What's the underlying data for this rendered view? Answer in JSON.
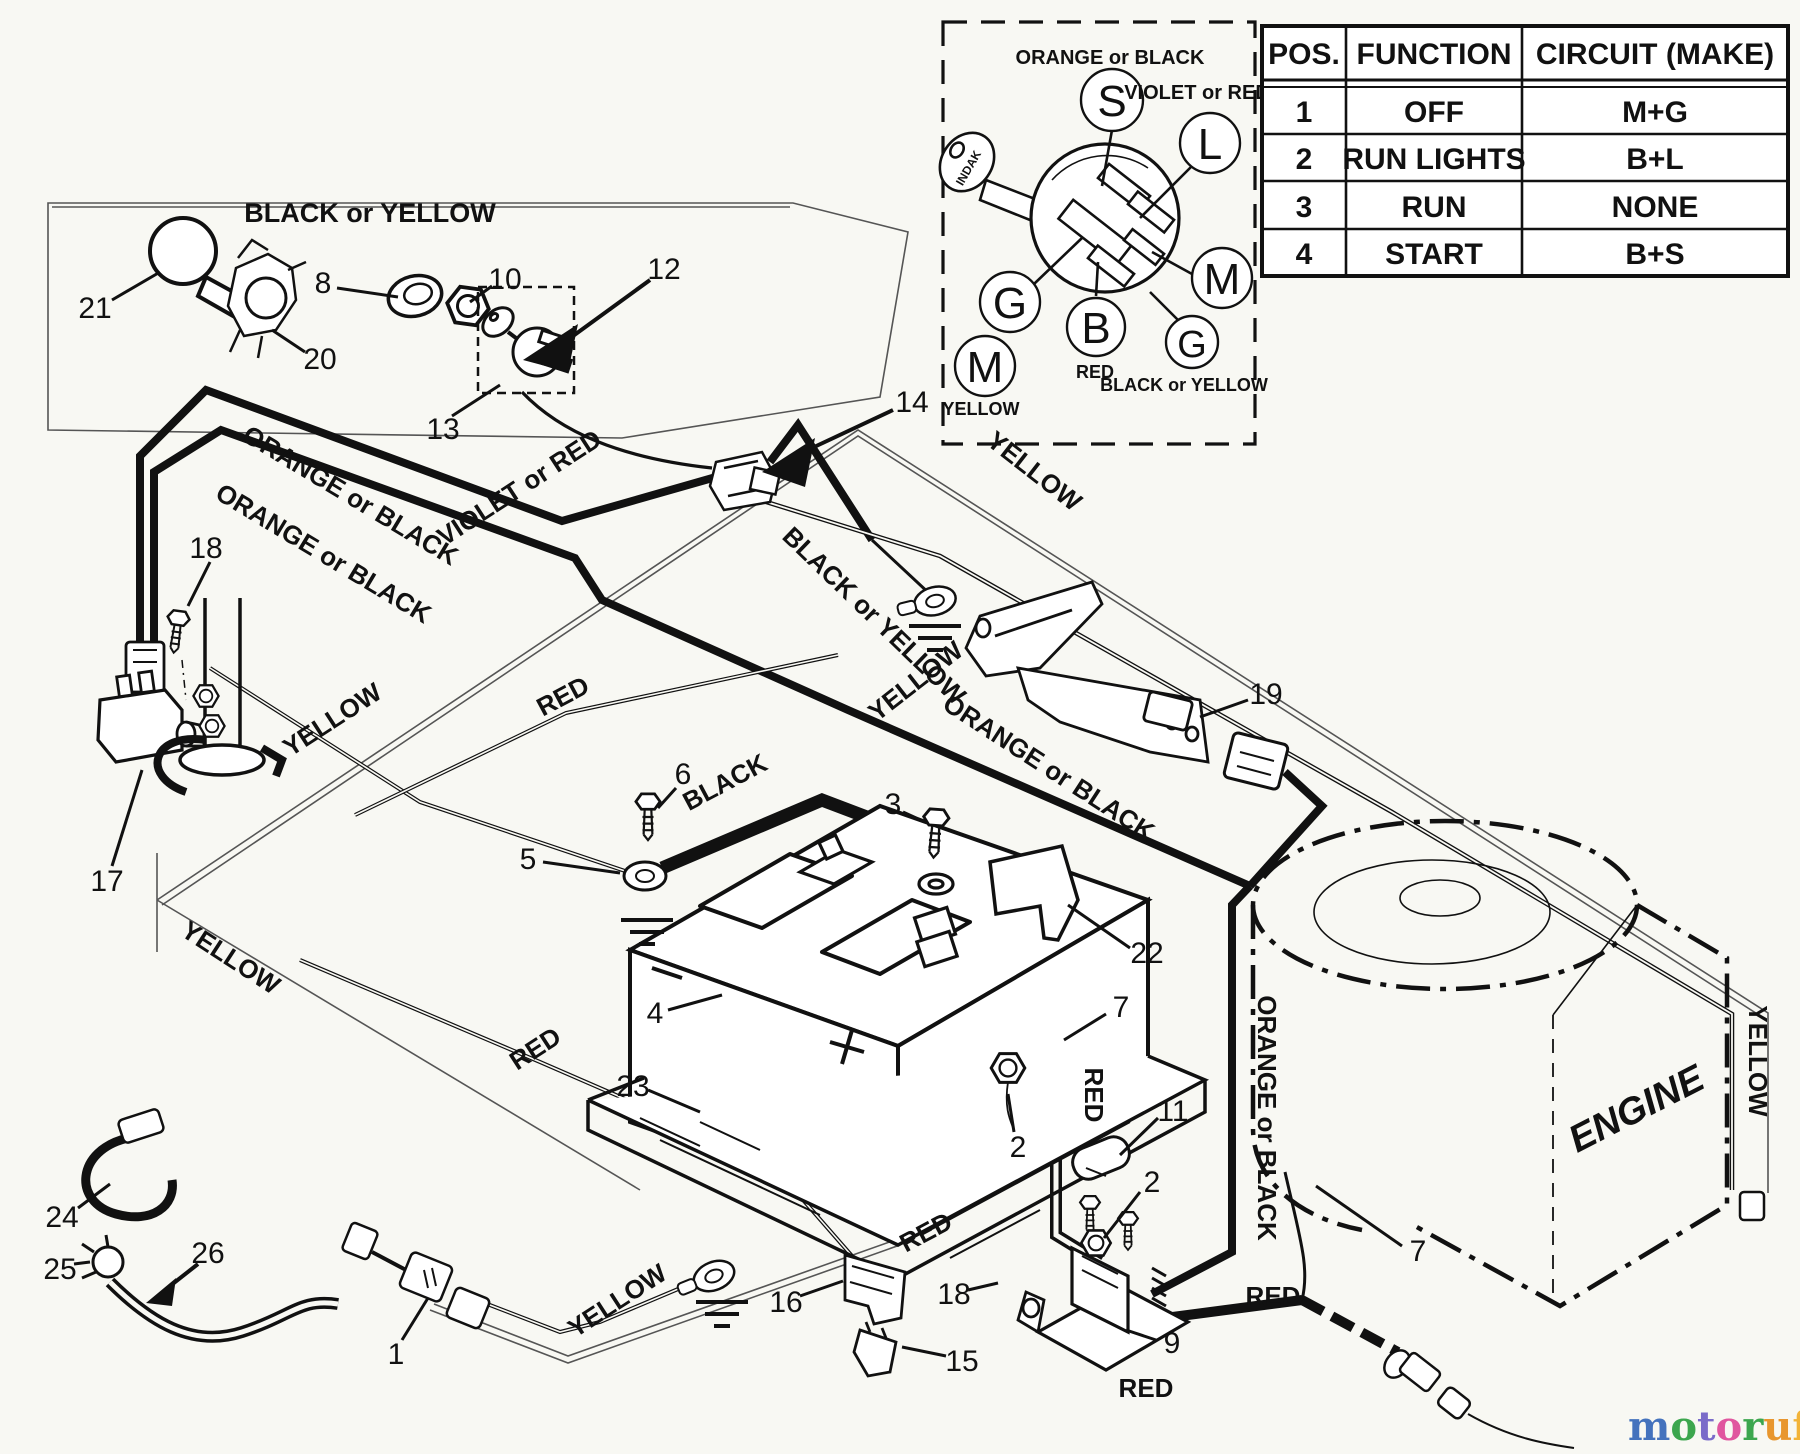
{
  "canvas": {
    "bg": "#f8f8f3",
    "ink": "#111111"
  },
  "table": {
    "headers": [
      "POS.",
      "FUNCTION",
      "CIRCUIT  (MAKE)"
    ],
    "rows": [
      [
        "1",
        "OFF",
        "M+G"
      ],
      [
        "2",
        "RUN LIGHTS",
        "B+L"
      ],
      [
        "3",
        "RUN",
        "NONE"
      ],
      [
        "4",
        "START",
        "B+S"
      ]
    ]
  },
  "inset": {
    "key_brand": "INDAK",
    "terminals": [
      "S",
      "L",
      "G",
      "B",
      "M",
      "G",
      "M"
    ],
    "labels": {
      "top": "ORANGE or BLACK",
      "violet": "VIOLET or RED",
      "red": "RED",
      "black_yellow": "BLACK or YELLOW",
      "yellow": "YELLOW"
    }
  },
  "wire_labels": [
    {
      "text": "BLACK or YELLOW"
    },
    {
      "text": "ORANGE or BLACK"
    },
    {
      "text": "ORANGE or BLACK"
    },
    {
      "text": "VIOLET or RED"
    },
    {
      "text": "BLACK or YELLOW"
    },
    {
      "text": "YELLOW"
    },
    {
      "text": "YELLOW"
    },
    {
      "text": "RED"
    },
    {
      "text": "BLACK"
    },
    {
      "text": "ORANGE or BLACK"
    },
    {
      "text": "YELLOW"
    },
    {
      "text": "YELLOW"
    },
    {
      "text": "RED"
    },
    {
      "text": "RED"
    },
    {
      "text": "ORANGE or BLACK"
    },
    {
      "text": "RED"
    },
    {
      "text": "YELLOW"
    },
    {
      "text": "RED"
    },
    {
      "text": "RED"
    },
    {
      "text": "YELLOW"
    },
    {
      "text": "ENGINE"
    }
  ],
  "callouts": [
    {
      "n": "21"
    },
    {
      "n": "20"
    },
    {
      "n": "8"
    },
    {
      "n": "10"
    },
    {
      "n": "12"
    },
    {
      "n": "13"
    },
    {
      "n": "14"
    },
    {
      "n": "18"
    },
    {
      "n": "17"
    },
    {
      "n": "19"
    },
    {
      "n": "6"
    },
    {
      "n": "5"
    },
    {
      "n": "3"
    },
    {
      "n": "4"
    },
    {
      "n": "23"
    },
    {
      "n": "22"
    },
    {
      "n": "7"
    },
    {
      "n": "2"
    },
    {
      "n": "11"
    },
    {
      "n": "2"
    },
    {
      "n": "24"
    },
    {
      "n": "25"
    },
    {
      "n": "26"
    },
    {
      "n": "1"
    },
    {
      "n": "16"
    },
    {
      "n": "15"
    },
    {
      "n": "18"
    },
    {
      "n": "9"
    },
    {
      "n": "7"
    }
  ],
  "logo": {
    "letters": [
      {
        "ch": "m",
        "color": "#4472bd"
      },
      {
        "ch": "o",
        "color": "#3ca64e"
      },
      {
        "ch": "t",
        "color": "#7a6bc9"
      },
      {
        "ch": "o",
        "color": "#e0569f"
      },
      {
        "ch": "r",
        "color": "#3ca64e"
      },
      {
        "ch": "u",
        "color": "#e8962e"
      },
      {
        "ch": "f",
        "color": "#f2b338"
      }
    ],
    "suffix": ".de"
  }
}
